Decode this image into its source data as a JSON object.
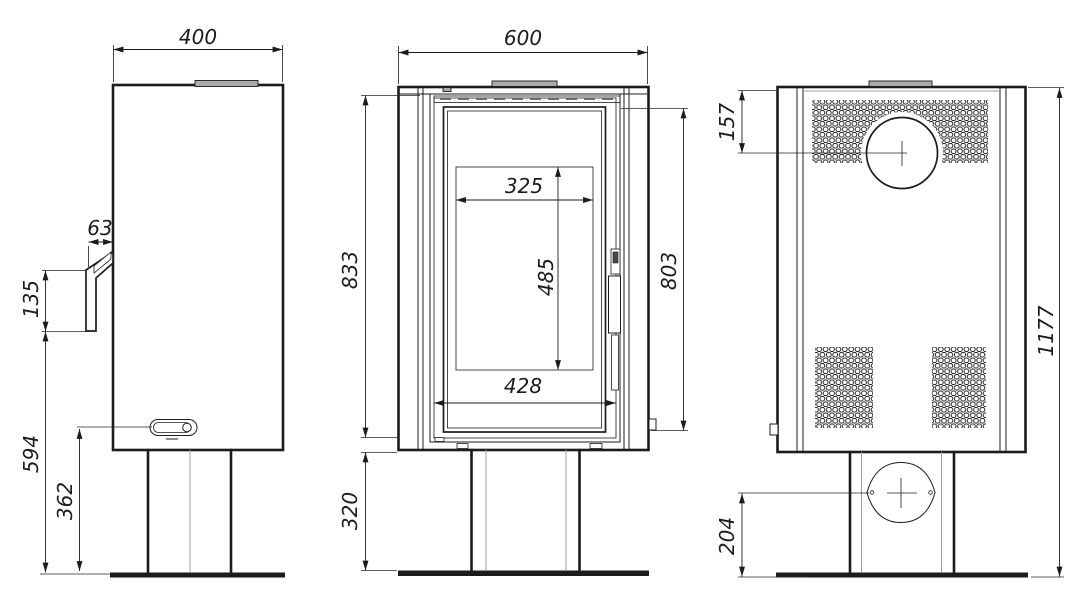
{
  "drawing": {
    "type": "technical-drawing",
    "subject": "freestanding wood stove on pedestal base, three orthographic views",
    "line_color": "#1c1c1c",
    "accent_fill": "#ababab",
    "views": {
      "side": {
        "name": "side view (left)",
        "dims": {
          "depth": "400",
          "handle_offset": "63",
          "handle_length": "135",
          "handle_to_floor": "594",
          "lever_to_floor": "362"
        }
      },
      "front": {
        "name": "front view (middle)",
        "dims": {
          "width": "600",
          "top_height": "833",
          "glass_width": "325",
          "glass_height": "485",
          "door_height": "803",
          "firebox_width": "428",
          "pedestal_height": "320"
        }
      },
      "back": {
        "name": "back view (right)",
        "dims": {
          "flue_offset_top": "157",
          "total_height": "1177",
          "inlet_height": "204"
        }
      }
    }
  }
}
